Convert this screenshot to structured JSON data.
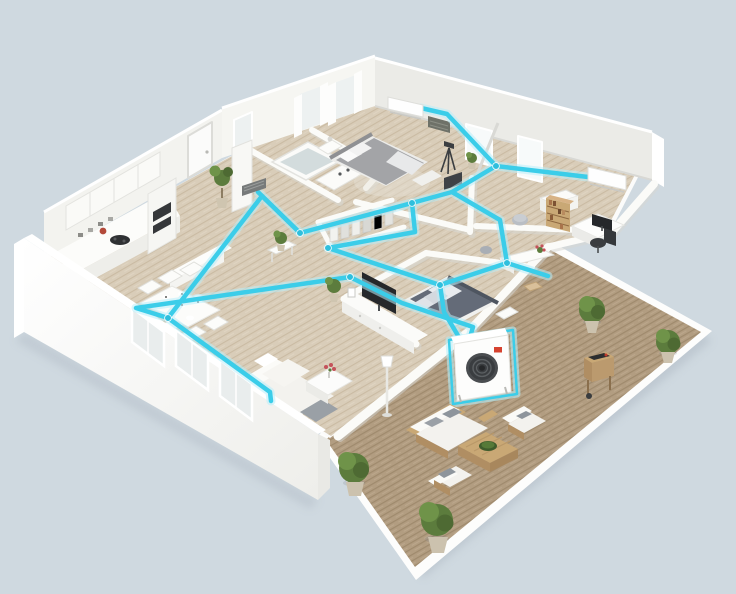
{
  "scene": {
    "type": "3d-floorplan-illustration",
    "subject": "Isometric cutaway apartment floor plan with ducted multi-split air conditioning system and furnished roof terrace",
    "canvas": {
      "width": 736,
      "height": 594
    }
  },
  "palette": {
    "background": "#cfd9e0",
    "wall_white": "#ffffff",
    "wall_face": "#f3f3ef",
    "wall_back": "#ebebe7",
    "wall_shadow": "#d8d8d4",
    "floor_wood": "#d9cdb9",
    "floor_stripe": "#cabba3",
    "deck_wood": "#b29d81",
    "deck_stripe": "#9f8a6d",
    "duct": "#3bcde9",
    "duct_glow": "#b9eefa",
    "duct_node": "#2fbfdd",
    "unit_fan": "#3a3d40",
    "logo_red": "#d6422f",
    "plant_green": "#5c7c3d",
    "plant_light": "#6f9349",
    "plant_dark": "#4e6a33",
    "timber": "#c9a875",
    "timber_dark": "#b08e63",
    "bed_gray": "#a3a4a7",
    "bed_navy": "#646b78",
    "screen": "#26282b",
    "glass": "#edf1f1",
    "cushion_gray": "#9aa0a6",
    "flower_red": "#c4525a",
    "water": "#d3dcdd"
  },
  "hvac": {
    "duct_color": "#3bcde9",
    "outdoor_unit": {
      "name": "outdoor-condenser-unit",
      "location": "terrace wall"
    },
    "indoor_units": [
      {
        "name": "wall-ac-master-bedroom"
      },
      {
        "name": "wall-ac-office"
      }
    ],
    "vents": [
      {
        "name": "duct-grille-bathroom"
      }
    ]
  },
  "rooms": [
    {
      "name": "kitchen"
    },
    {
      "name": "dining-area"
    },
    {
      "name": "entry-hall"
    },
    {
      "name": "bathroom"
    },
    {
      "name": "master-bedroom"
    },
    {
      "name": "walk-in-closet"
    },
    {
      "name": "hallway"
    },
    {
      "name": "home-office"
    },
    {
      "name": "dressing-room"
    },
    {
      "name": "second-bedroom"
    },
    {
      "name": "living-room"
    },
    {
      "name": "terrace"
    }
  ],
  "furnishings": {
    "kitchen": [
      "wall-cabinets",
      "oven-tower",
      "cooktop",
      "counter",
      "island-bar",
      "bar-stool"
    ],
    "dining-area": [
      "dining-table",
      "six-chairs",
      "tableware"
    ],
    "bathroom": [
      "bathtub",
      "vanity-sink",
      "duct-grille"
    ],
    "master-bedroom": [
      "double-bed",
      "nightstand",
      "tripod-lamp",
      "curtained-windows",
      "media-unit"
    ],
    "walk-in-closet": [
      "clothes-racks"
    ],
    "home-office": [
      "bookshelf",
      "desk",
      "monitor",
      "office-chair",
      "pouf"
    ],
    "dressing-room": [
      "vanity-table",
      "stool",
      "flower-pot",
      "pouf"
    ],
    "second-bedroom": [
      "double-bed",
      "tv-console",
      "television"
    ],
    "living-room": [
      "sectional-sofa",
      "coffee-table",
      "flower-vase",
      "tv-console",
      "television",
      "floor-lamp",
      "potted-plant"
    ],
    "terrace": [
      "outdoor-sofa",
      "armchair-north",
      "armchair-south",
      "timber-coffee-table",
      "bbq-grill",
      "potted-shrubs"
    ]
  }
}
